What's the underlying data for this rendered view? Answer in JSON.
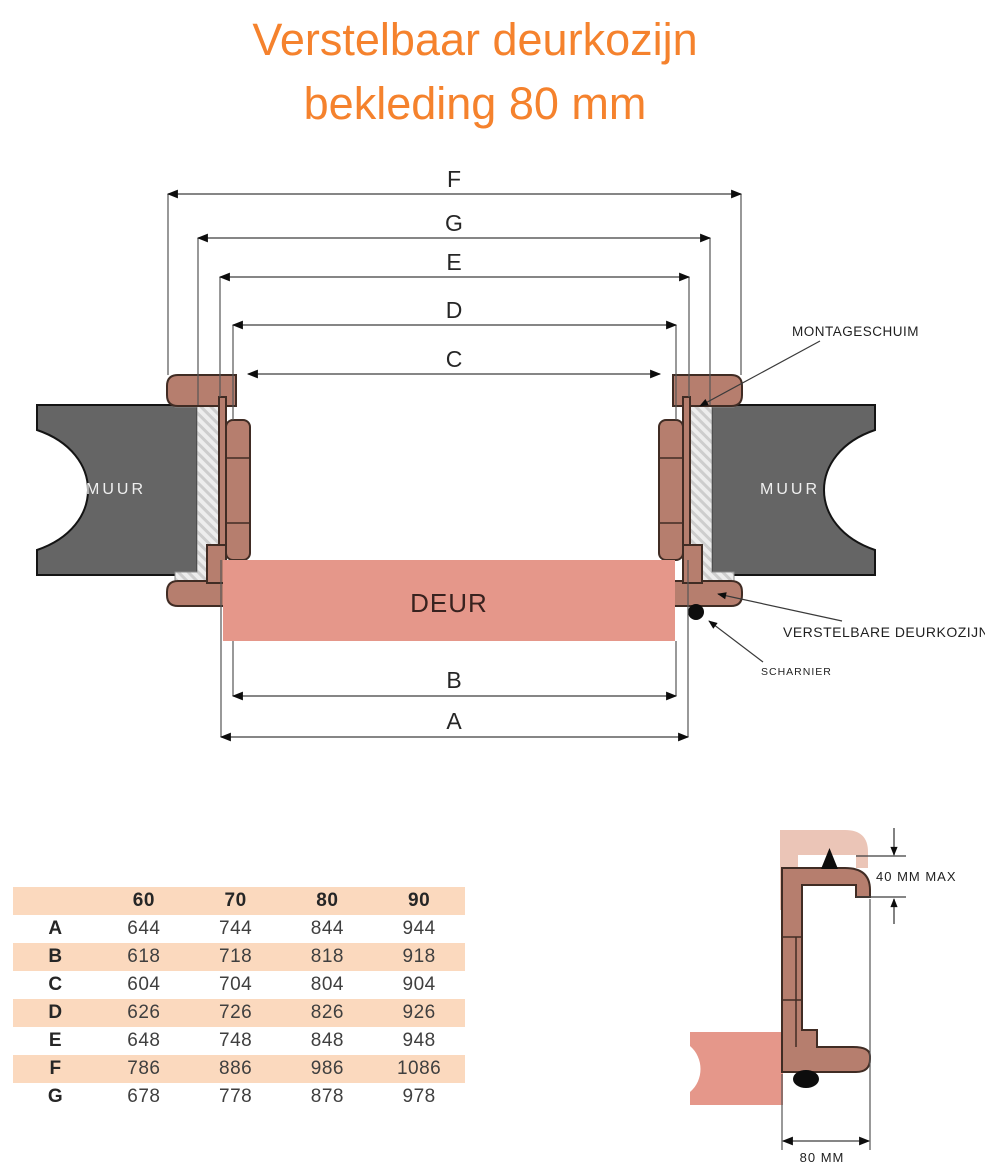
{
  "title": {
    "line1": "Verstelbaar deurkozijn",
    "line2": "bekleding 80 mm"
  },
  "diagram": {
    "dimension_labels": {
      "F": "F",
      "G": "G",
      "E": "E",
      "D": "D",
      "C": "C",
      "B": "B",
      "A": "A"
    },
    "wall_label_left": "MUUR",
    "wall_label_right": "MUUR",
    "door_label": "DEUR",
    "annotations": {
      "montageschuim": "MONTAGESCHUIM",
      "verstelbare_deurkozijn": "VERSTELBARE DEURKOZIJN",
      "scharnier": "SCHARNIER"
    }
  },
  "detail": {
    "adjust_range_label": "40 MM MAX",
    "cladding_width_label": "80 MM"
  },
  "table": {
    "column_headers": [
      "",
      "60",
      "70",
      "80",
      "90"
    ],
    "rows": [
      {
        "label": "A",
        "values": [
          "644",
          "744",
          "844",
          "944"
        ]
      },
      {
        "label": "B",
        "values": [
          "618",
          "718",
          "818",
          "918"
        ]
      },
      {
        "label": "C",
        "values": [
          "604",
          "704",
          "804",
          "904"
        ]
      },
      {
        "label": "D",
        "values": [
          "626",
          "726",
          "826",
          "926"
        ]
      },
      {
        "label": "E",
        "values": [
          "648",
          "748",
          "848",
          "948"
        ]
      },
      {
        "label": "F",
        "values": [
          "786",
          "886",
          "986",
          "1086"
        ]
      },
      {
        "label": "G",
        "values": [
          "678",
          "778",
          "878",
          "978"
        ]
      }
    ]
  },
  "colors": {
    "title_orange": "#F5822D",
    "frame_brown": "#B67E6E",
    "door_salmon": "#E5978A",
    "light_profile": "#EBC5B7",
    "wall_gray": "#656565",
    "table_peach": "#FBD9BE",
    "foam_gray": "#ECECEC"
  }
}
